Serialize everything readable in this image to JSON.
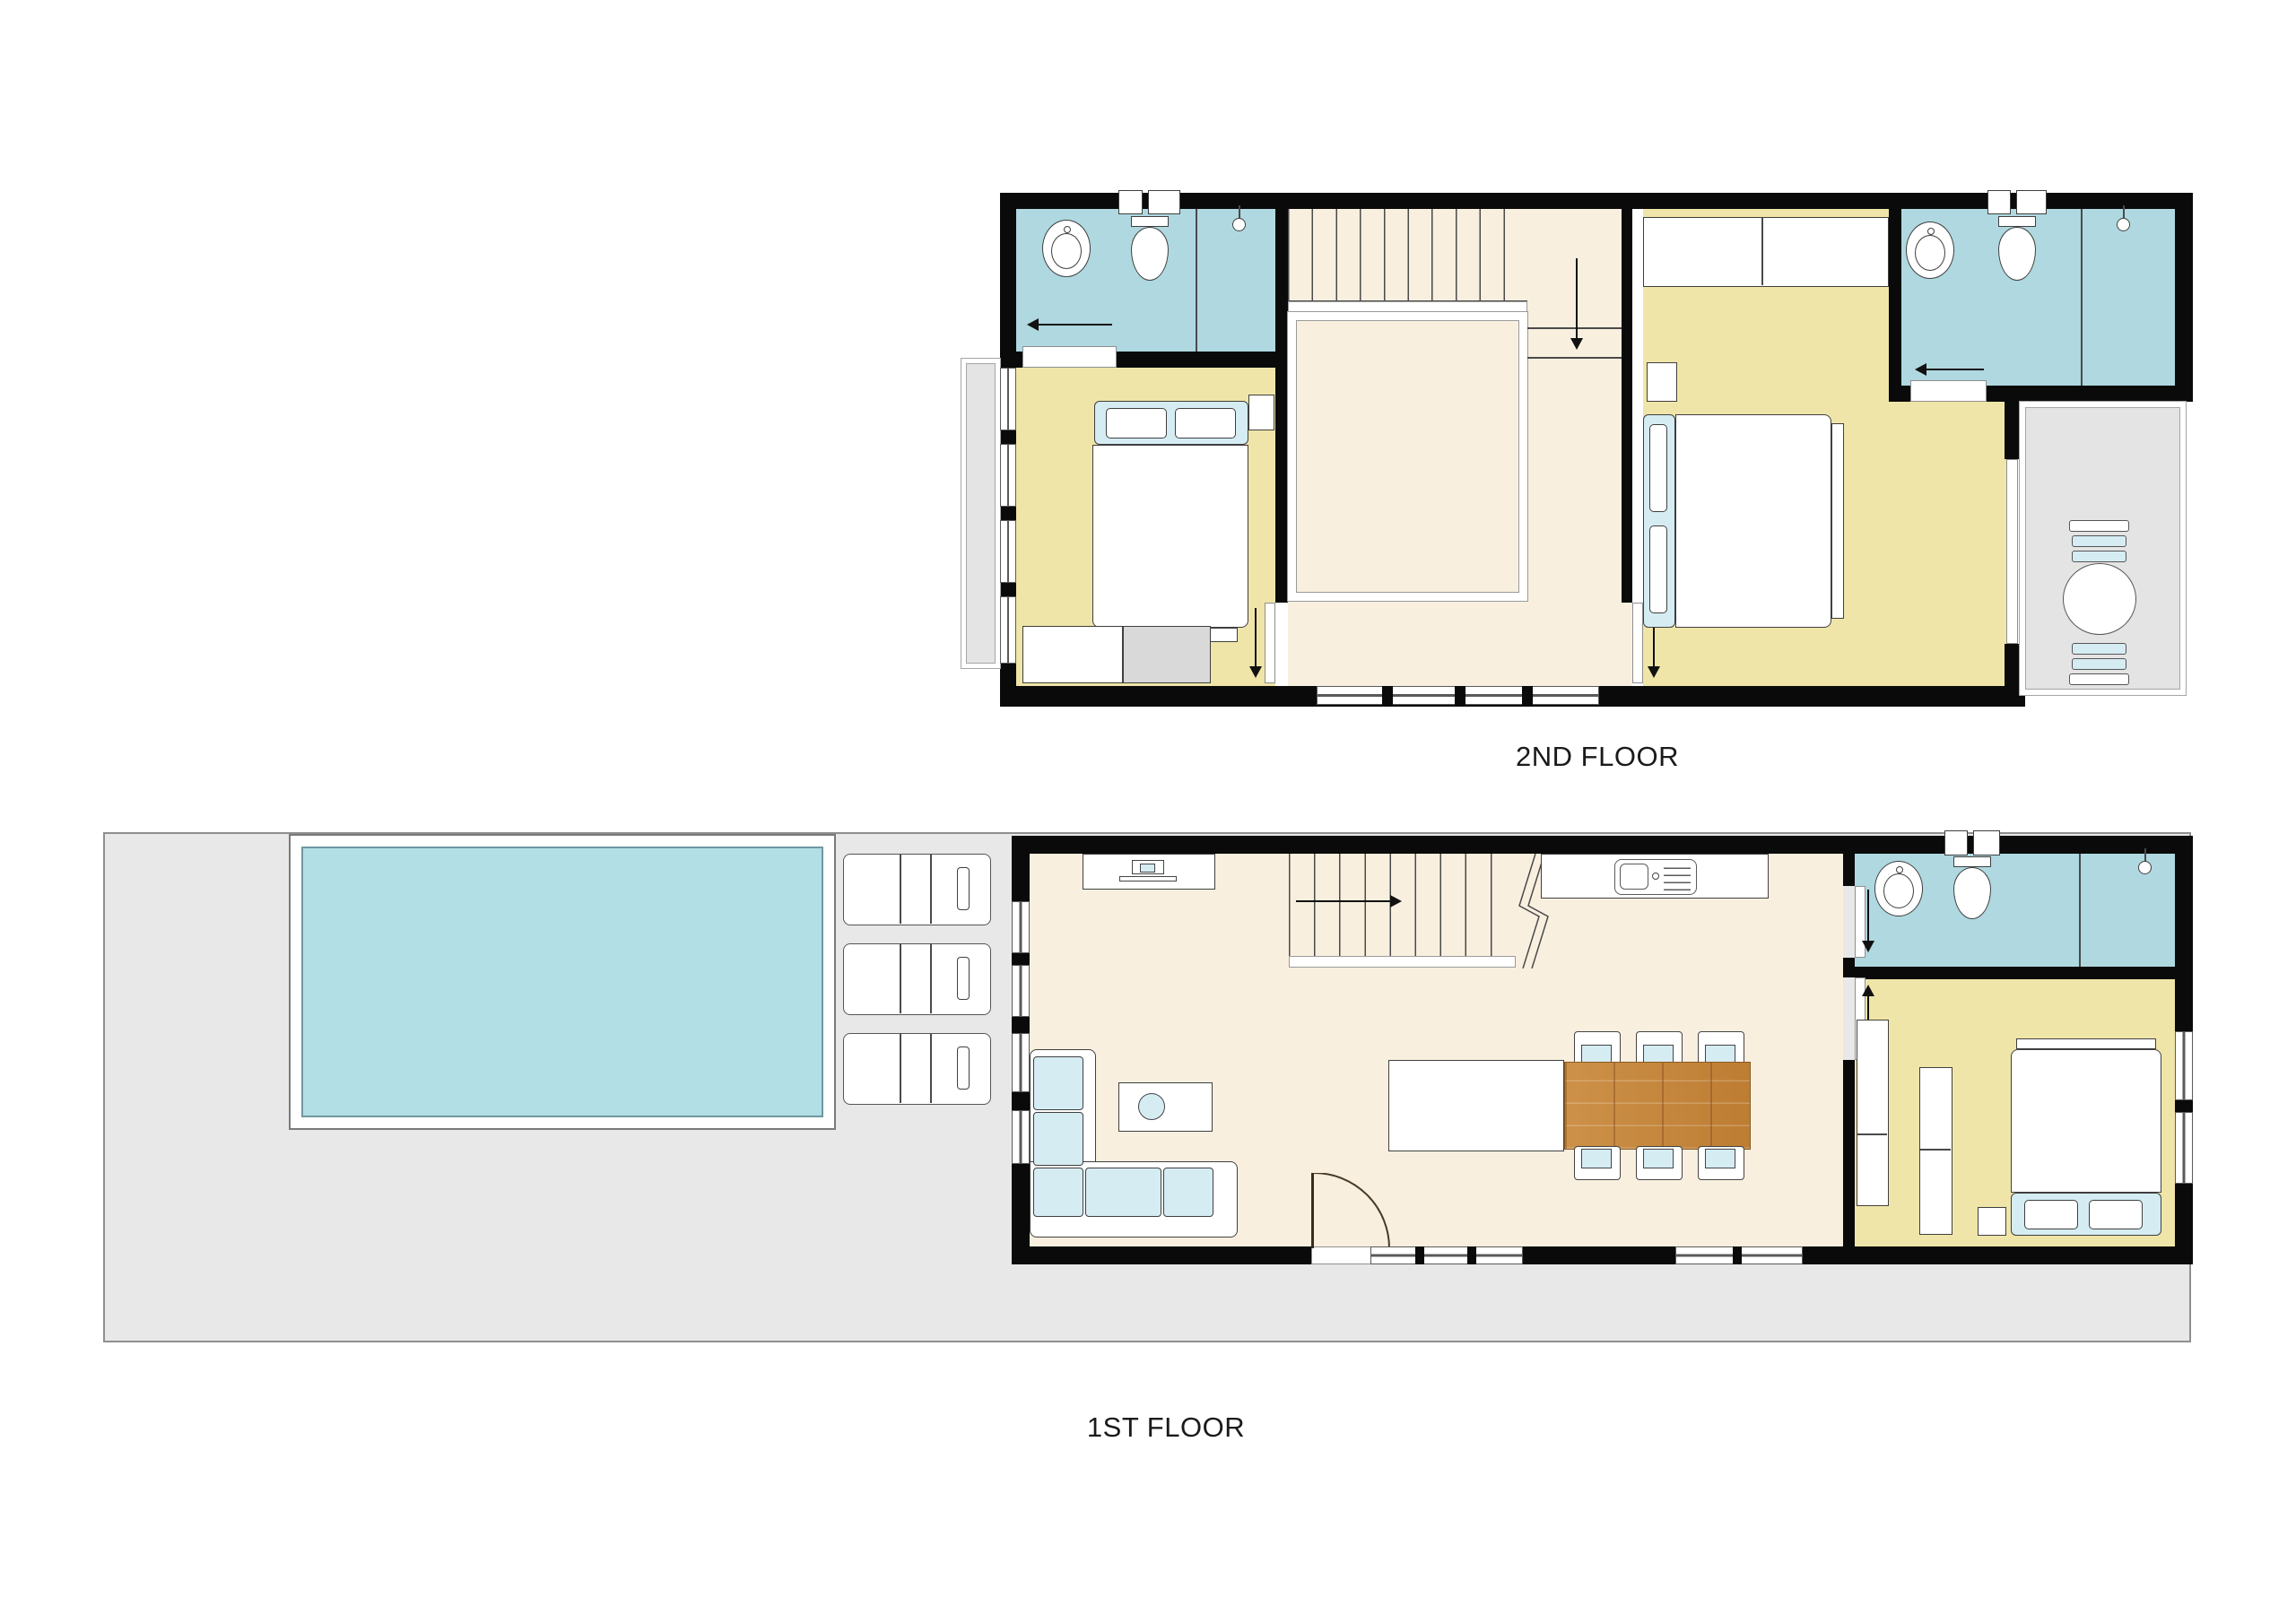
{
  "palette": {
    "wall": "#0a0a0a",
    "line": "#3f3f3f",
    "floor-hall": "#f8efdf",
    "floor-bedroom": "#efe5a8",
    "floor-bath": "#afd8e0",
    "pool-water": "#b2dee6",
    "terrace": "#e9e8e8",
    "balcony": "#e5e4e4",
    "cushion": "#d5ecf3",
    "wood": "#c6893f",
    "label-color": "#1a1a1a"
  },
  "labels": {
    "floor2": "2ND FLOOR",
    "floor1": "1ST FLOOR"
  },
  "floor2": {
    "label": "2ND FLOOR",
    "rooms": [
      "bathroom-1",
      "bedroom-1",
      "stair-hall",
      "void-over-living",
      "bedroom-2",
      "bathroom-2",
      "balcony",
      "juliet-balcony"
    ],
    "furniture": [
      "double-bed-1",
      "nightstand-1",
      "desk",
      "dresser",
      "wardrobe",
      "double-bed-2",
      "nightstand-2",
      "round-table",
      "balcony-chairs",
      "sink-1",
      "toilet-1",
      "shower-1",
      "sink-2",
      "toilet-2",
      "shower-2"
    ],
    "stairs": {
      "direction": "down",
      "treads": 10
    }
  },
  "floor1": {
    "label": "1ST FLOOR",
    "rooms": [
      "terrace",
      "swimming-pool",
      "living-dining-kitchen",
      "bathroom",
      "bedroom"
    ],
    "furniture": [
      "pool-loungers",
      "tv-cabinet",
      "corner-sofa",
      "coffee-table",
      "kitchen-counter-with-sink",
      "kitchen-island",
      "dining-table",
      "dining-chairs-6",
      "wardrobe",
      "tall-cabinet",
      "nightstand",
      "double-bed",
      "sink",
      "toilet",
      "shower"
    ],
    "stairs": {
      "direction": "up",
      "treads": 9
    }
  }
}
